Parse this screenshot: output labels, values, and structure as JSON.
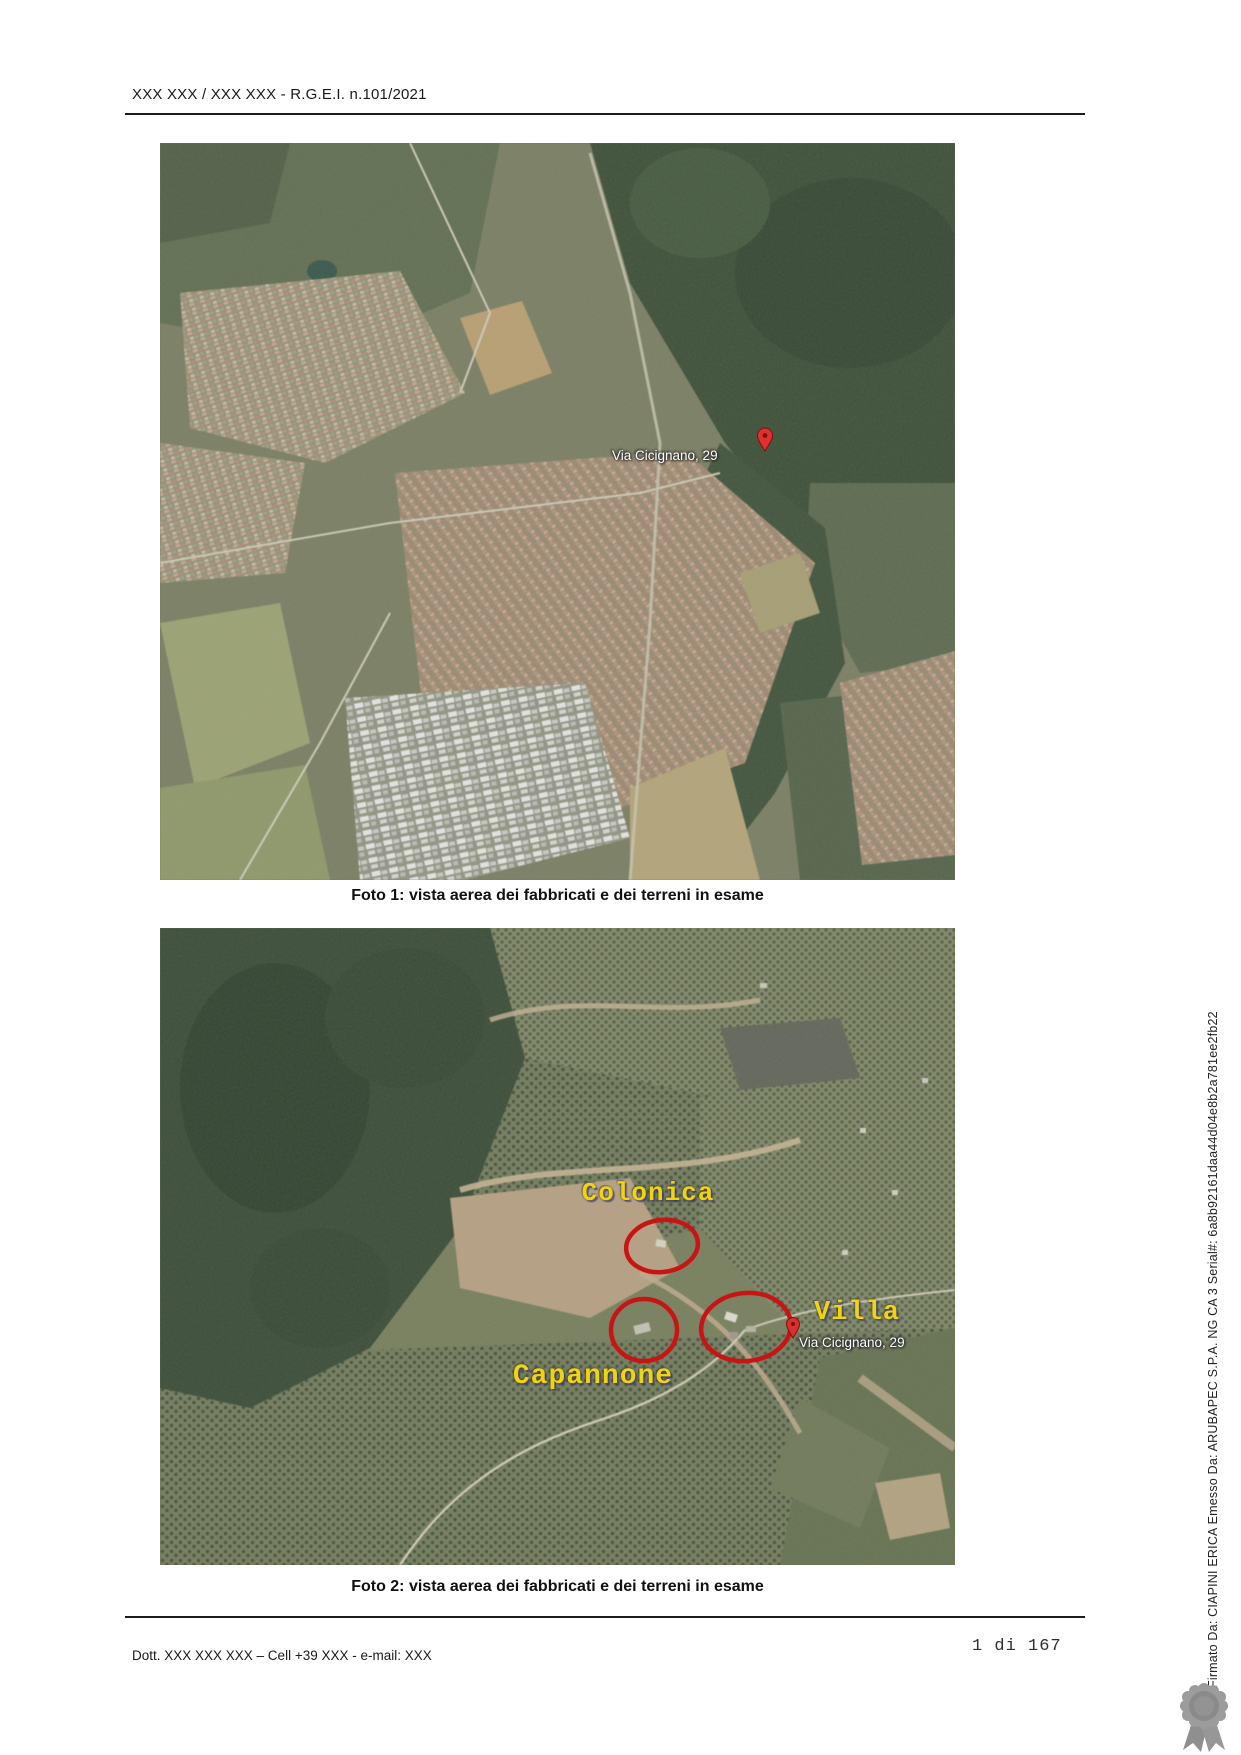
{
  "page": {
    "header": {
      "title": "XXX XXX / XXX XXX - R.G.E.I. n.101/2021"
    },
    "footer": {
      "contact": "Dott. XXX XXX XXX – Cell +39 XXX - e-mail: XXX",
      "page_number": "1 di 167"
    },
    "signature_sidebar": "Firmato Da: CIAPINI ERICA Emesso Da: ARUBAPEC S.P.A. NG CA 3 Serial#: 6a8b92161daa44d04e8b2a781ee2fb22"
  },
  "photo1": {
    "caption": "Foto 1: vista aerea dei fabbricati e dei terreni in esame",
    "pin_label": "Via Cicignano, 29",
    "pin_icon": "map-pin-icon"
  },
  "photo2": {
    "caption": "Foto 2: vista aerea dei fabbricati e dei terreni in esame",
    "pin_label": "Via Cicignano, 29",
    "pin_icon": "map-pin-icon",
    "annotations": [
      {
        "label": "Colonica"
      },
      {
        "label": "Villa"
      },
      {
        "label": "Capannone"
      }
    ]
  },
  "icons": {
    "pin": "map-pin-icon",
    "seal": "ribbon-seal-icon"
  },
  "colors": {
    "annotation_yellow": "#f0d40c",
    "annotation_red": "#c81414",
    "pin_red": "#e03030",
    "forest_dark": "#31432e",
    "terrain_olive": "#75795d"
  }
}
